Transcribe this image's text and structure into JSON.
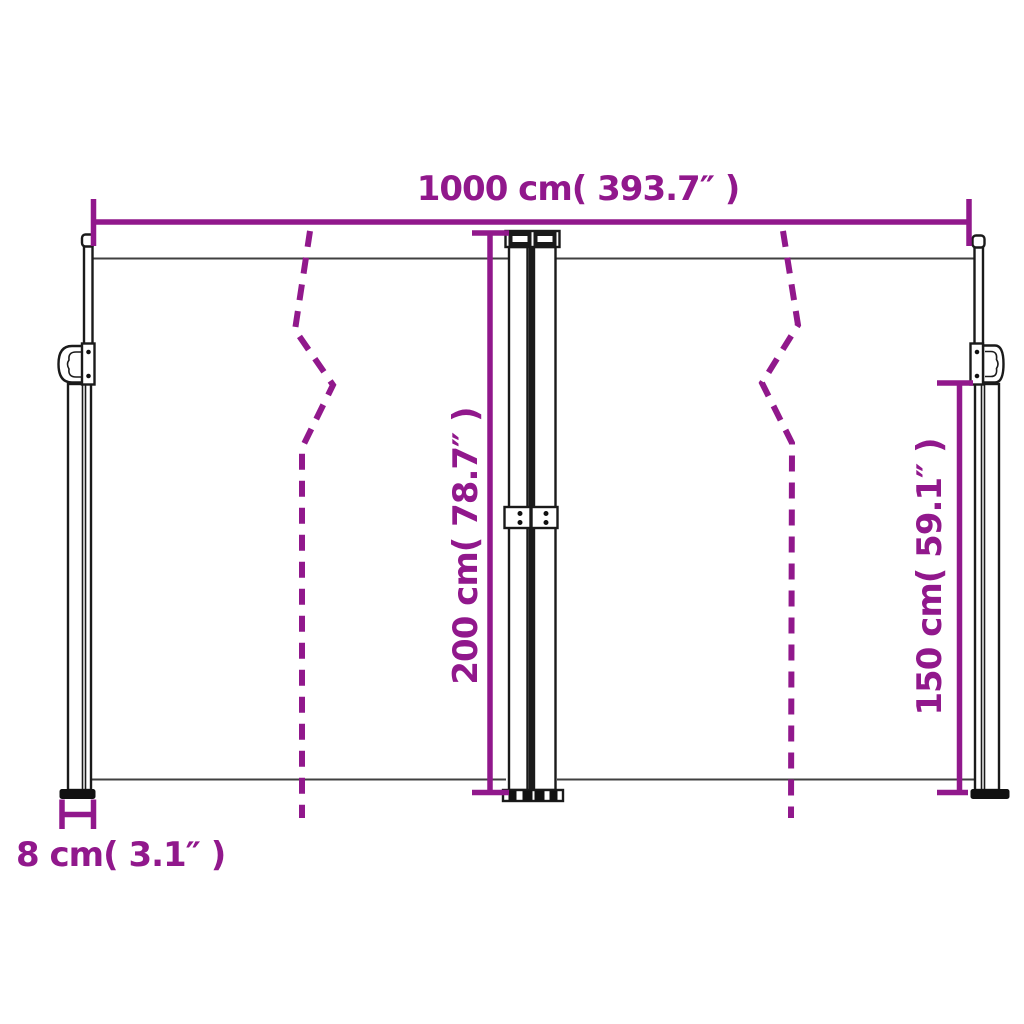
{
  "diagram": {
    "type": "product-dimension-diagram",
    "colors": {
      "accent": "#91188C",
      "structure": "#1a1a1a",
      "fabric_line": "#404040",
      "background": "#ffffff"
    },
    "dimensions": {
      "total_width": {
        "label": "1000 cm( 393.7″ )",
        "value_cm": 1000,
        "value_inch": 393.7
      },
      "height_total": {
        "label": "200 cm( 78.7″ )",
        "value_cm": 200,
        "value_inch": 78.7
      },
      "height_lower": {
        "label": "150 cm( 59.1″ )",
        "value_cm": 150,
        "value_inch": 59.1
      },
      "post_width": {
        "label": "8 cm( 3.1″ )",
        "value_cm": 8,
        "value_inch": 3.1
      }
    }
  }
}
